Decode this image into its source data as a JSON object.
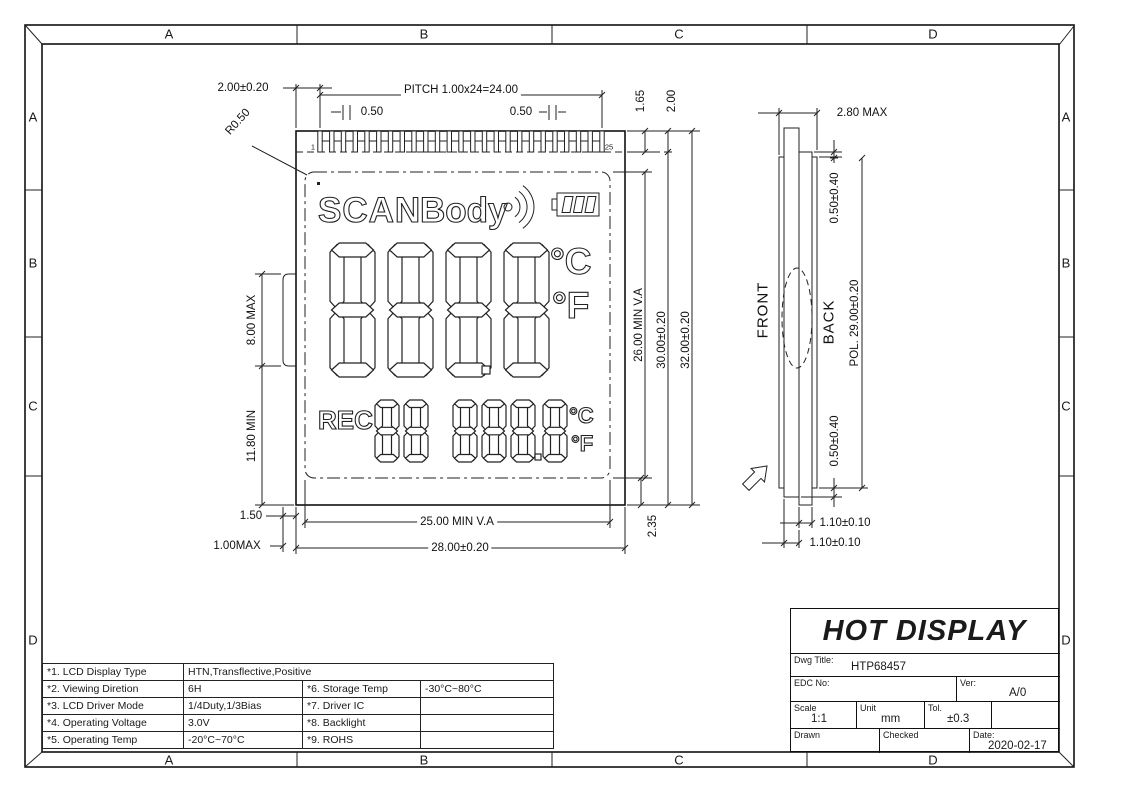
{
  "border": {
    "letters": [
      "A",
      "B",
      "C",
      "D"
    ]
  },
  "front_view": {
    "pins": {
      "first": "1",
      "last": "25"
    },
    "dims": {
      "lead_left": "2.00±0.20",
      "radius": "R0.50",
      "pitch": "PITCH 1.00x24=24.00",
      "pin_width_left": "0.50",
      "pin_width_right": "0.50",
      "top_right_1": "1.65",
      "top_right_2": "2.00",
      "tab_height": "8.00 MAX",
      "tab_to_bottom": "11.80 MIN",
      "va_height": "26.00 MIN V.A",
      "height_inner": "30.00±0.20",
      "height_total": "32.00±0.20",
      "bottom_offset_1": "1.50",
      "bottom_offset_2": "1.00MAX",
      "va_width": "25.00 MIN V.A",
      "width_total": "28.00±0.20",
      "va_to_edge": "2.35"
    },
    "lcd": {
      "scan": "SCAN",
      "body": "Body",
      "main_digits": "8888",
      "deg_c": "°C",
      "deg_f": "°F",
      "rec": "REC",
      "sub_digits_left": "88",
      "sub_digits_right": "888.8",
      "sub_deg_c": "°C",
      "sub_deg_f": "°F"
    }
  },
  "side_view": {
    "front_label": "FRONT",
    "back_label": "BACK",
    "thickness": "2.80 MAX",
    "pol_offset_top": "0.50±0.40",
    "pol_length": "POL. 29.00±0.20",
    "pol_offset_bottom": "0.50±0.40",
    "glass_back": "1.10±0.10",
    "glass_front": "1.10±0.10"
  },
  "title_block": {
    "company": "HOT DISPLAY",
    "dwg_title_label": "Dwg Title:",
    "dwg_title": "HTP68457",
    "edc_label": "EDC No:",
    "ver_label": "Ver:",
    "ver": "A/0",
    "scale_label": "Scale",
    "scale": "1:1",
    "unit_label": "Unit",
    "unit": "mm",
    "tol_label": "Tol.",
    "tol": "±0.3",
    "drawn_label": "Drawn",
    "checked_label": "Checked",
    "date_label": "Date:",
    "date": "2020-02-17"
  },
  "spec_table": {
    "rows": [
      {
        "label": "*1. LCD Display Type",
        "value": "HTN,Transflective,Positive",
        "label2": "",
        "value2": ""
      },
      {
        "label": "*2. Viewing Diretion",
        "value": "6H",
        "label2": "*6. Storage Temp",
        "value2": "-30°C~80°C"
      },
      {
        "label": "*3. LCD Driver Mode",
        "value": "1/4Duty,1/3Bias",
        "label2": "*7. Driver IC",
        "value2": ""
      },
      {
        "label": "*4. Operating Voltage",
        "value": "3.0V",
        "label2": "*8. Backlight",
        "value2": ""
      },
      {
        "label": "*5. Operating Temp",
        "value": "-20°C~70°C",
        "label2": "*9. ROHS",
        "value2": ""
      }
    ]
  },
  "colors": {
    "line": "#222222",
    "background": "#ffffff"
  }
}
